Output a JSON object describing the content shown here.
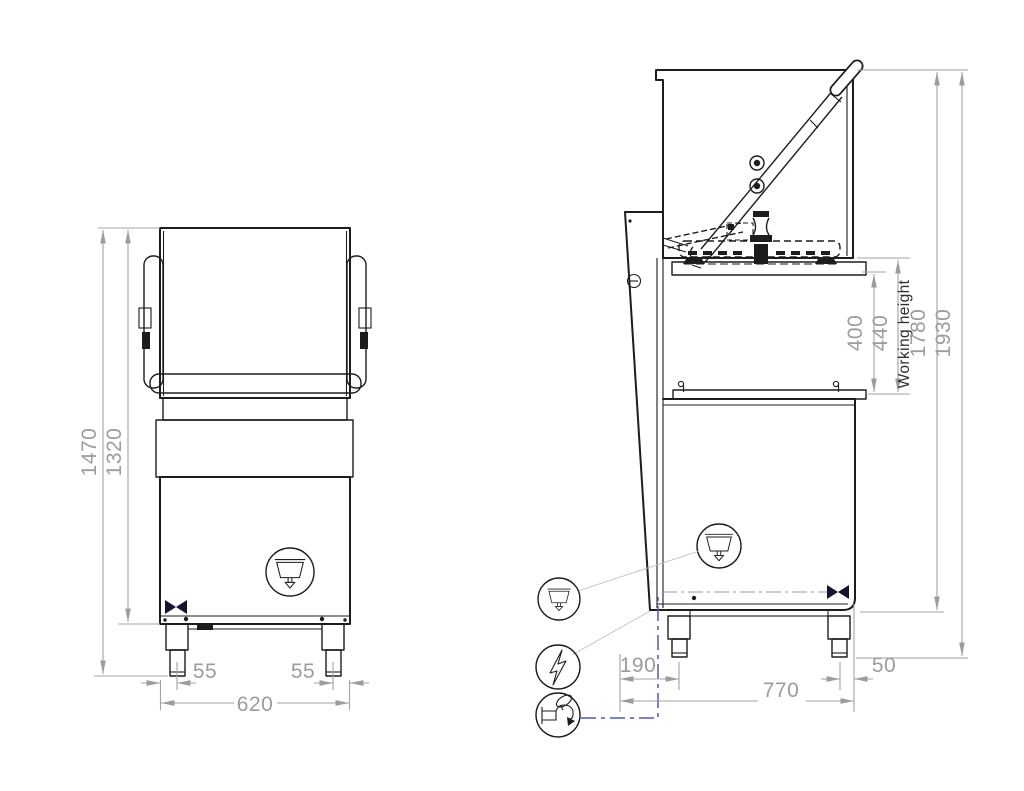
{
  "front_view": {
    "dims": {
      "overall_height": "1470",
      "body_height": "1320",
      "foot_inset_left": "55",
      "foot_inset_right": "55",
      "overall_width": "620"
    },
    "symbols": {
      "drain": "basin-drain-symbol",
      "drain_valve": "bowtie-valve-symbol"
    }
  },
  "side_view": {
    "dims": {
      "opening_min": "400",
      "opening_max": "440",
      "working_height_label": "Working height",
      "height_hood_closed": "1780",
      "height_hood_open": "1930",
      "water_inlet_offset": "190",
      "overall_depth": "770",
      "rear_foot_offset": "50"
    },
    "symbols": {
      "drain": "basin-drain-symbol",
      "electrical": "lightning-bolt-symbol",
      "water": "water-tap-symbol",
      "drain_valve": "bowtie-valve-symbol"
    }
  },
  "colors": {
    "line": "#1d1d1d",
    "dimension": "#9c9c9c",
    "annotation_blue": "#5159b5",
    "valve_navy": "#14142f",
    "background": "#ffffff"
  }
}
